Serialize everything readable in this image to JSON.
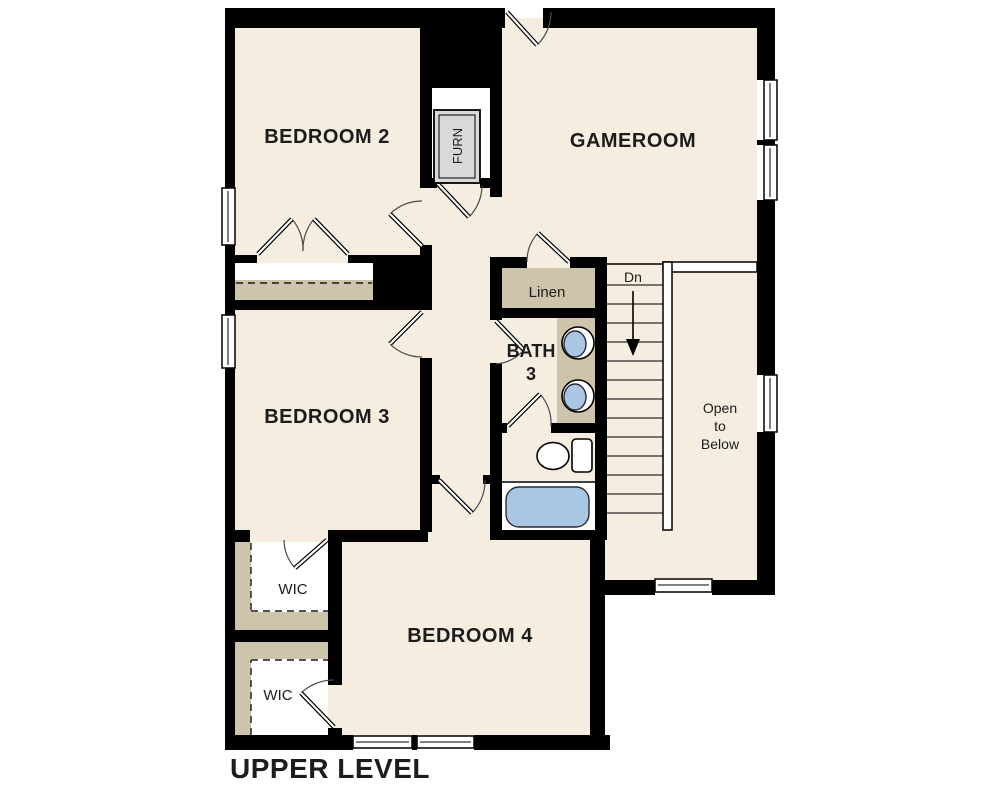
{
  "title": "UPPER LEVEL",
  "colors": {
    "background": "#ffffff",
    "floor": "#f5eee0",
    "wall": "#000000",
    "shelf_tan": "#cec3ab",
    "fixture_blue": "#a9c6e5",
    "furnace_grey": "#d9d9d9"
  },
  "rooms": {
    "bedroom2": {
      "label": "BEDROOM 2"
    },
    "gameroom": {
      "label": "GAMEROOM"
    },
    "bedroom3": {
      "label": "BEDROOM 3"
    },
    "bedroom4": {
      "label": "BEDROOM 4"
    },
    "bath3": {
      "label_line1": "BATH",
      "label_line2": "3"
    },
    "linen": {
      "label": "Linen"
    },
    "wic_upper": {
      "label": "WIC"
    },
    "wic_lower": {
      "label": "WIC"
    },
    "open_to_below": {
      "label_line1": "Open",
      "label_line2": "to",
      "label_line3": "Below"
    },
    "furnace": {
      "label": "FURN"
    },
    "stairs": {
      "direction_label": "Dn"
    }
  }
}
